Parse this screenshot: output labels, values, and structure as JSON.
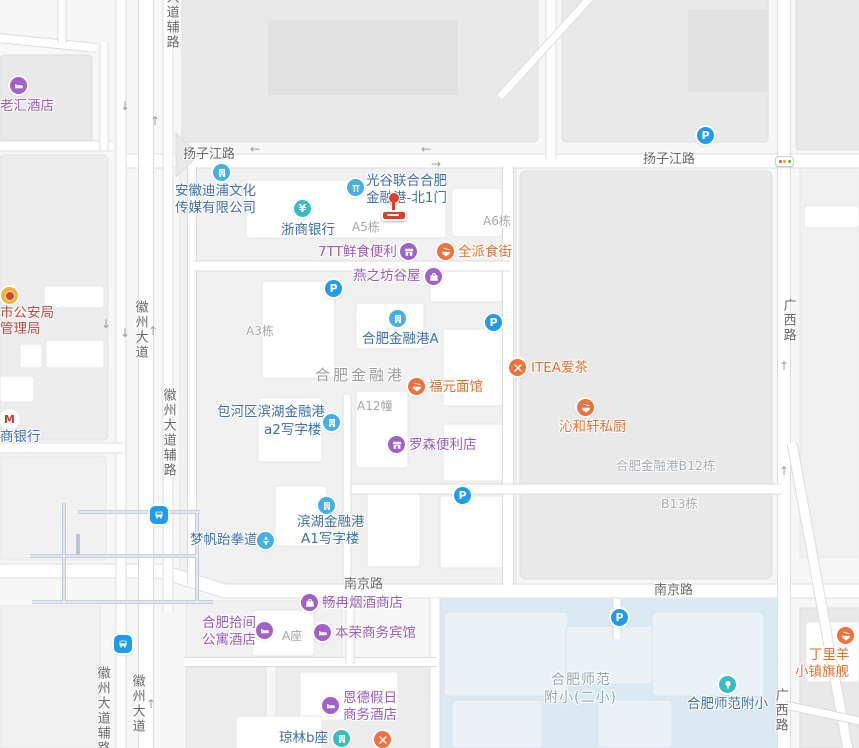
{
  "glyphs": {
    "parking": "P",
    "yen": "¥",
    "bank_m": "M",
    "up": "↑",
    "down": "↓",
    "left": "←",
    "right": "→"
  },
  "roads": {
    "yangzijiang": "扬子江路",
    "nanjing": "南京路",
    "dadao_fulu": "大道辅路",
    "huizhou_dadao": "徽州大道",
    "huizhou_fulu": "徽州大道辅路",
    "guangxi": "广西路"
  },
  "areas": {
    "a5": "A5栋",
    "a6": "A6栋",
    "a3": "A3栋",
    "a12": "A12幢",
    "campus": "合肥金融港",
    "b12": "合肥金融港B12栋",
    "b13": "B13栋",
    "a_block": "A座",
    "school_line1": "合肥师范",
    "school_line2": "附小(二小)"
  },
  "pois": {
    "laohui": {
      "line1": "老汇酒店"
    },
    "dipu": {
      "line1": "安徽迪浦文化",
      "line2": "传媒有限公司"
    },
    "zheshang": {
      "line1": "浙商银行"
    },
    "guanggu": {
      "line1": "光谷联合合肥",
      "line2": "金融港-北1门"
    },
    "seven_tt": {
      "line1": "7TT鲜食便利"
    },
    "quanpai": {
      "line1": "全派食街"
    },
    "yanzhifang": {
      "line1": "燕之坊谷屋"
    },
    "jinronggang_a": {
      "line1": "合肥金融港A"
    },
    "itea": {
      "line1": "ITEA爱茶"
    },
    "fuyuan": {
      "line1": "福元面馆"
    },
    "qinhexuan": {
      "line1": "沁和轩私厨"
    },
    "baohe_a2": {
      "line1": "包河区滨湖金融港",
      "line2": "a2写字楼"
    },
    "luosen": {
      "line1": "罗森便利店"
    },
    "binhu_a1": {
      "line1": "滨湖金融港",
      "line2": "A1写字楼"
    },
    "mengfan": {
      "line1": "梦帆跆拳道"
    },
    "changran": {
      "line1": "畅冉烟酒商店"
    },
    "shijian": {
      "line1": "合肥拾间",
      "line2": "公寓酒店"
    },
    "benrong": {
      "line1": "本荣商务宾馆"
    },
    "ende": {
      "line1": "恩德假日",
      "line2": "商务酒店"
    },
    "qionglin": {
      "line1": "琼林b座"
    },
    "shifan": {
      "line1": "合肥师范附小"
    },
    "dingliyang": {
      "line1": "丁里羊",
      "line2": "小镇旗舰"
    },
    "police": {
      "line1": "市公安局",
      "line2": "管理局"
    },
    "bank": {
      "line1": "商银行"
    }
  }
}
